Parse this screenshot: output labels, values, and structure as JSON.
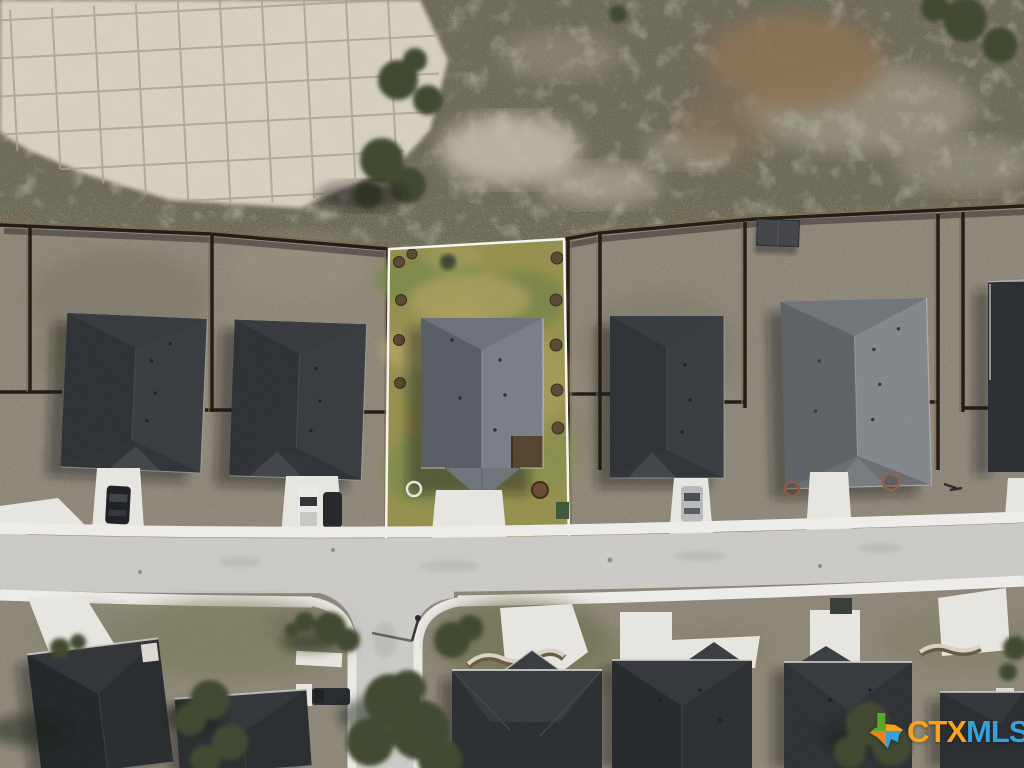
{
  "watermark": {
    "prefix": "CTX",
    "suffix": "MLS",
    "icon": "texas-state-icon"
  },
  "palette": {
    "scrub_base": "#6e6a58",
    "scrub_light": "#c9c3b2",
    "chalk_pad": "#dbd4c5",
    "chalk_grid": "#a99f8c",
    "brown_dirt": "#8a7257",
    "dirt_base": "#8e8779",
    "dirt_dark": "#746e5f",
    "lawn_base": "#96914f",
    "lawn_green": "#7c8a4a",
    "lawn_tan": "#b3a467",
    "boundary_white": "#f6f5ef",
    "road": "#cbcac6",
    "curb": "#edece8",
    "concrete": "#e7e5e0",
    "roof_dark": "#33363a",
    "roof_gray": "#6f747a",
    "roof_light": "#84888c",
    "shadow": "rgba(17,17,20,0.42)",
    "fence_dark": "#221d17",
    "fence_wood": "#7c6a4e",
    "bush": "#5c4936",
    "tree_dark": "#434a33",
    "car_dark": "#1f2124",
    "car_white": "#e9e9e6",
    "car_silver": "#b9babb",
    "wm_prefix": "#f7a31c",
    "wm_suffix": "#399fd8",
    "wm_green": "#5ba829",
    "wm_orange": "#e8821e"
  }
}
